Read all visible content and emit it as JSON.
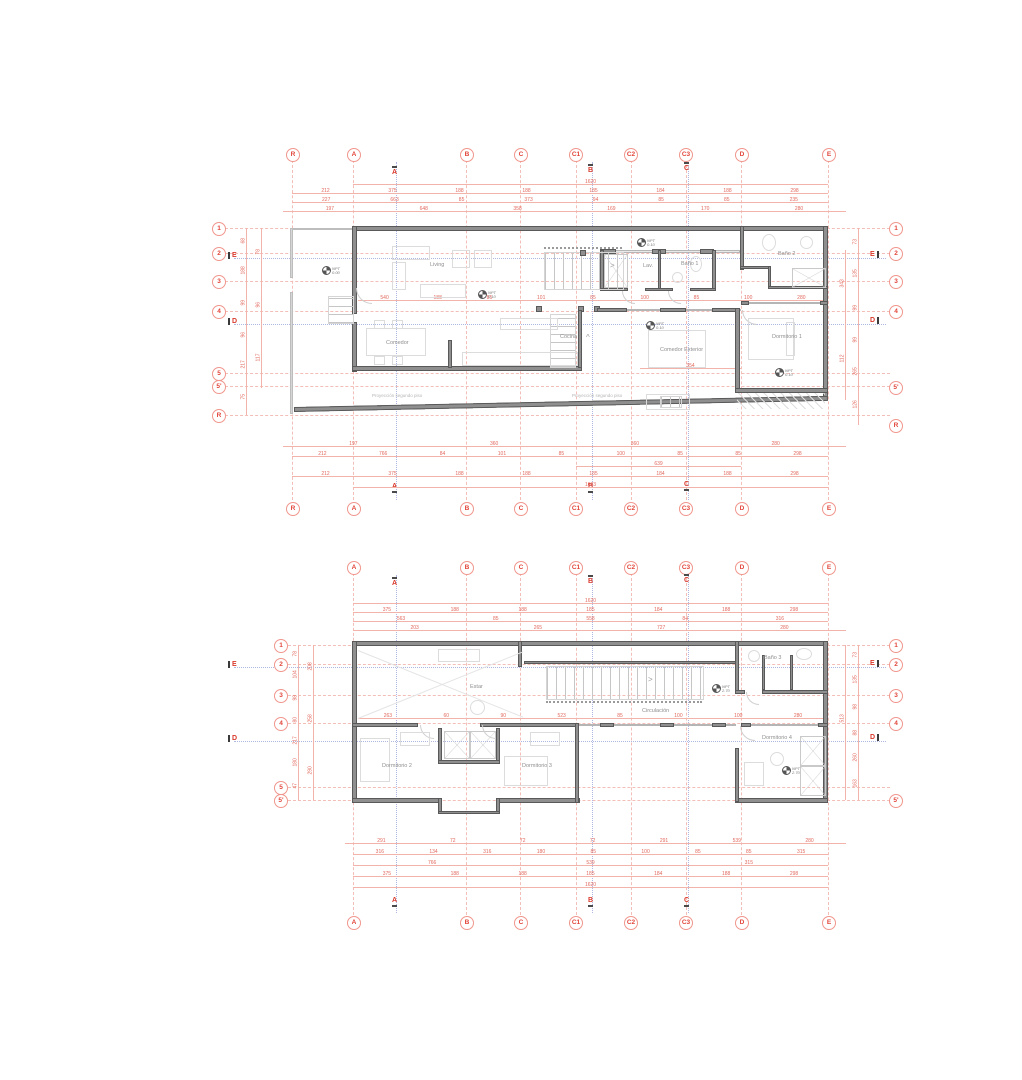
{
  "shared": {
    "npt_label": "NPT",
    "stair_arrow": ">",
    "up_arrow": "^"
  },
  "plan_ground": {
    "grid_cols": [
      "R",
      "A",
      "B",
      "C",
      "C1",
      "C2",
      "C3",
      "D",
      "E"
    ],
    "rows_left": [
      "1",
      "2",
      "3",
      "4",
      "5",
      "5'",
      "R"
    ],
    "rows_right": [
      "1",
      "2",
      "3",
      "4",
      "5'",
      "R"
    ],
    "sections": {
      "a": "A",
      "b": "B",
      "c": "C",
      "e": "E",
      "d": "D"
    },
    "rooms": {
      "living": "Living",
      "comedor": "Comedor",
      "cocina": "Cocina",
      "lav": "Lav.",
      "bano1": "Baño 1",
      "bano2": "Baño 2",
      "comedor_ext": "Comedor Exterior",
      "dorm1": "Dormitorio 1"
    },
    "notes": {
      "proj": "Proyección segundo piso"
    },
    "npt": {
      "entry": "0.00",
      "living": "0.10",
      "hall": "0.10",
      "ext": "0.10",
      "dorm1": "0.10"
    },
    "dims": {
      "top_total": "1620",
      "top_row2": [
        "212",
        "375",
        "188",
        "188",
        "185",
        "184",
        "188",
        "298"
      ],
      "top_row3": [
        "227",
        "663",
        "85",
        "373",
        "94",
        "85",
        "85",
        "235"
      ],
      "top_row4": [
        "197",
        "648",
        "358",
        "169",
        "170",
        "280"
      ],
      "interior": [
        "540",
        "188",
        "85",
        "101",
        "85",
        "100",
        "85",
        "100",
        "280"
      ],
      "comedor_ext_width": "354",
      "bottom_row1": [
        "197",
        "360",
        "360",
        "280"
      ],
      "bottom_row2": [
        "212",
        "766",
        "84",
        "101",
        "85",
        "100",
        "85",
        "85",
        "298"
      ],
      "bottom_row3": [
        "639"
      ],
      "bottom_row4": [
        "212",
        "375",
        "188",
        "188",
        "185",
        "184",
        "188",
        "298"
      ],
      "bottom_total": "1683",
      "left_col1": [
        "68",
        "188",
        "99",
        "96",
        "217",
        "75"
      ],
      "left_col2": [
        "78",
        "96",
        "117"
      ],
      "right_col1": [
        "73",
        "135",
        "99",
        "99",
        "265",
        "126"
      ],
      "right_col2": [
        "343",
        "112"
      ]
    }
  },
  "plan_upper": {
    "grid_cols": [
      "A",
      "B",
      "C",
      "C1",
      "C2",
      "C3",
      "D",
      "E"
    ],
    "rows_left": [
      "1",
      "2",
      "3",
      "4",
      "5",
      "5'"
    ],
    "rows_right": [
      "1",
      "2",
      "3",
      "4",
      "5'"
    ],
    "sections": {
      "a": "A",
      "b": "B",
      "c": "C",
      "e": "E",
      "d": "D"
    },
    "rooms": {
      "estar": "Estar",
      "bano3": "Baño 3",
      "circulacion": "Circulación",
      "dorm2": "Dormitorio 2",
      "dorm3": "Dormitorio 3",
      "dorm4": "Dormitorio 4"
    },
    "npt": {
      "hall": "2.70",
      "dorm4": "2.70"
    },
    "dims": {
      "top_total": "1620",
      "top_row2": [
        "375",
        "188",
        "188",
        "185",
        "184",
        "188",
        "298"
      ],
      "top_row3": [
        "563",
        "85",
        "558",
        "84",
        "316"
      ],
      "top_row4": [
        "203",
        "265",
        "727",
        "280"
      ],
      "interior": [
        "263",
        "60",
        "90",
        "523",
        "85",
        "100",
        "100",
        "280"
      ],
      "bottom_row1": [
        "291",
        "72",
        "72",
        "72",
        "291",
        "539",
        "280"
      ],
      "bottom_row2": [
        "316",
        "134",
        "316",
        "180",
        "85",
        "100",
        "85",
        "85",
        "315"
      ],
      "bottom_row3": [
        "766",
        "539",
        "315"
      ],
      "bottom_row4": [
        "375",
        "188",
        "188",
        "185",
        "184",
        "188",
        "298"
      ],
      "bottom_total": "1620",
      "left_col1": [
        "78",
        "104",
        "98",
        "80",
        "217",
        "180",
        "47"
      ],
      "left_col2": [
        "208",
        "258",
        "290"
      ],
      "right_col1": [
        "73",
        "135",
        "98",
        "88",
        "260",
        "163"
      ],
      "right_col2": [
        "513"
      ]
    }
  }
}
